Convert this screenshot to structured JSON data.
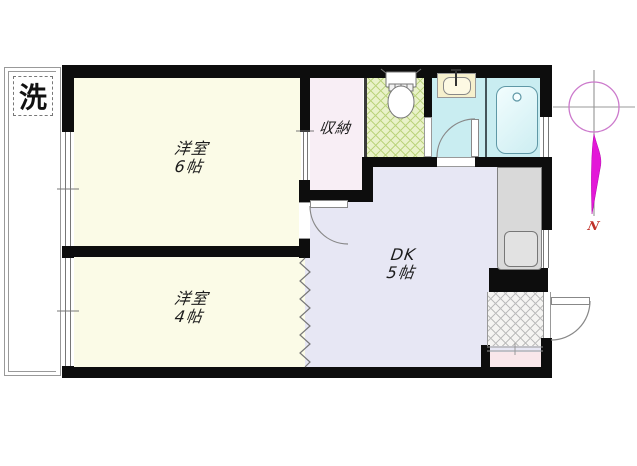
{
  "labels": {
    "room6": {
      "name": "洋室",
      "size": "6帖"
    },
    "room4": {
      "name": "洋室",
      "size": "4帖"
    },
    "dk": {
      "name": "DK",
      "size": "5帖"
    },
    "closet": "収納",
    "laundry": "洗",
    "north": "N"
  },
  "colors": {
    "wall": "#0d0d0d",
    "cream": "#fbfbe7",
    "lavender": "#e7e7f4",
    "closetpink": "#f8eef5",
    "cyan": "#c9edf1",
    "toiletbase": "#e9f2c9",
    "toiletline": "#bcd47e",
    "genkanbase": "#f5f4f2",
    "genkanline": "#bdbdbd",
    "entrypink": "#f9e7ea",
    "kitchen": "#d9d9d9",
    "tubline": "#5f98a6",
    "magenta": "#e318d8",
    "circlepink": "#cc7acc",
    "northred": "#c03028"
  }
}
